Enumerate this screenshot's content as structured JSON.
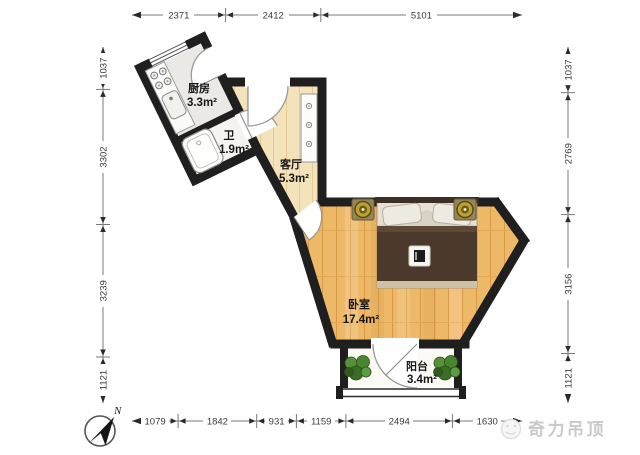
{
  "plan": {
    "rooms": {
      "kitchen": {
        "name": "厨房",
        "area": "3.3m²"
      },
      "bath": {
        "name": "卫",
        "area": "1.9m²"
      },
      "living": {
        "name": "客厅",
        "area": "5.3m²"
      },
      "bedroom": {
        "name": "卧室",
        "area": "17.4m²"
      },
      "balcony": {
        "name": "阳台",
        "area": "3.4m²"
      }
    },
    "dimensions": {
      "top": [
        "2371",
        "2412",
        "5101"
      ],
      "bottom": [
        "1079",
        "1842",
        "931",
        "1159",
        "2494",
        "1630"
      ],
      "left": [
        "1037",
        "3302",
        "3239",
        "1121"
      ],
      "right": [
        "1037",
        "2769",
        "3156",
        "1121"
      ]
    },
    "compass_label": "N",
    "watermark": "奇力吊顶",
    "colors": {
      "wall": "#1f1f1f",
      "bedroom_wood": "#edb868",
      "living_floor": "#f4e2bb",
      "kitchen_floor": "#eae9e5",
      "balcony_floor": "#fbfaf5",
      "plant_green": "#4c8a2f",
      "duvet_brown": "#4b3a2b",
      "lamp_gold": "#bfa22e"
    }
  }
}
